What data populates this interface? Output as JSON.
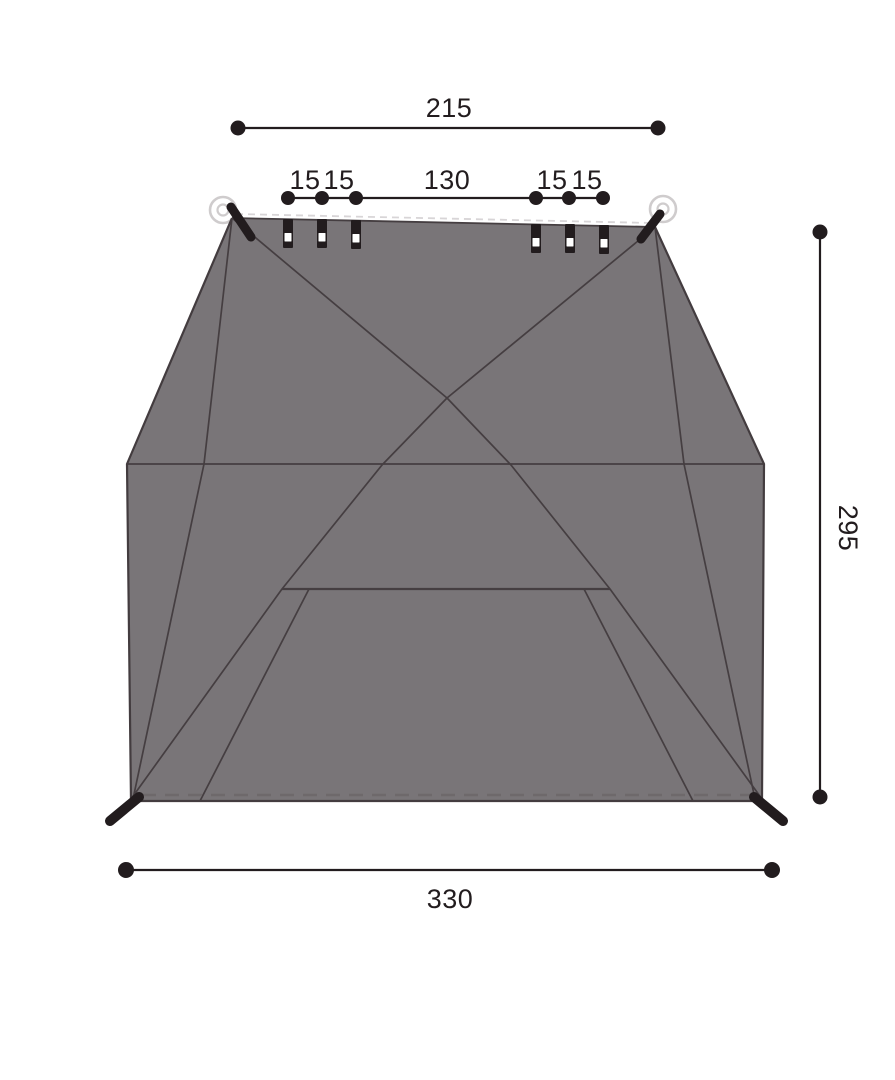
{
  "dimensions": {
    "top_width": "215",
    "top_segments": [
      "15",
      "15",
      "130",
      "15",
      "15"
    ],
    "side_depth": "295",
    "bottom_width": "330"
  },
  "colors": {
    "background": "#ffffff",
    "fabric_fill": "#797578",
    "seam_line": "#453e41",
    "outline": "#433c3f",
    "ink": "#221c1e",
    "stitch_light": "#d8d5d7",
    "stitch_dark": "#6e696b",
    "grommet_ring": "#cfcccd"
  }
}
